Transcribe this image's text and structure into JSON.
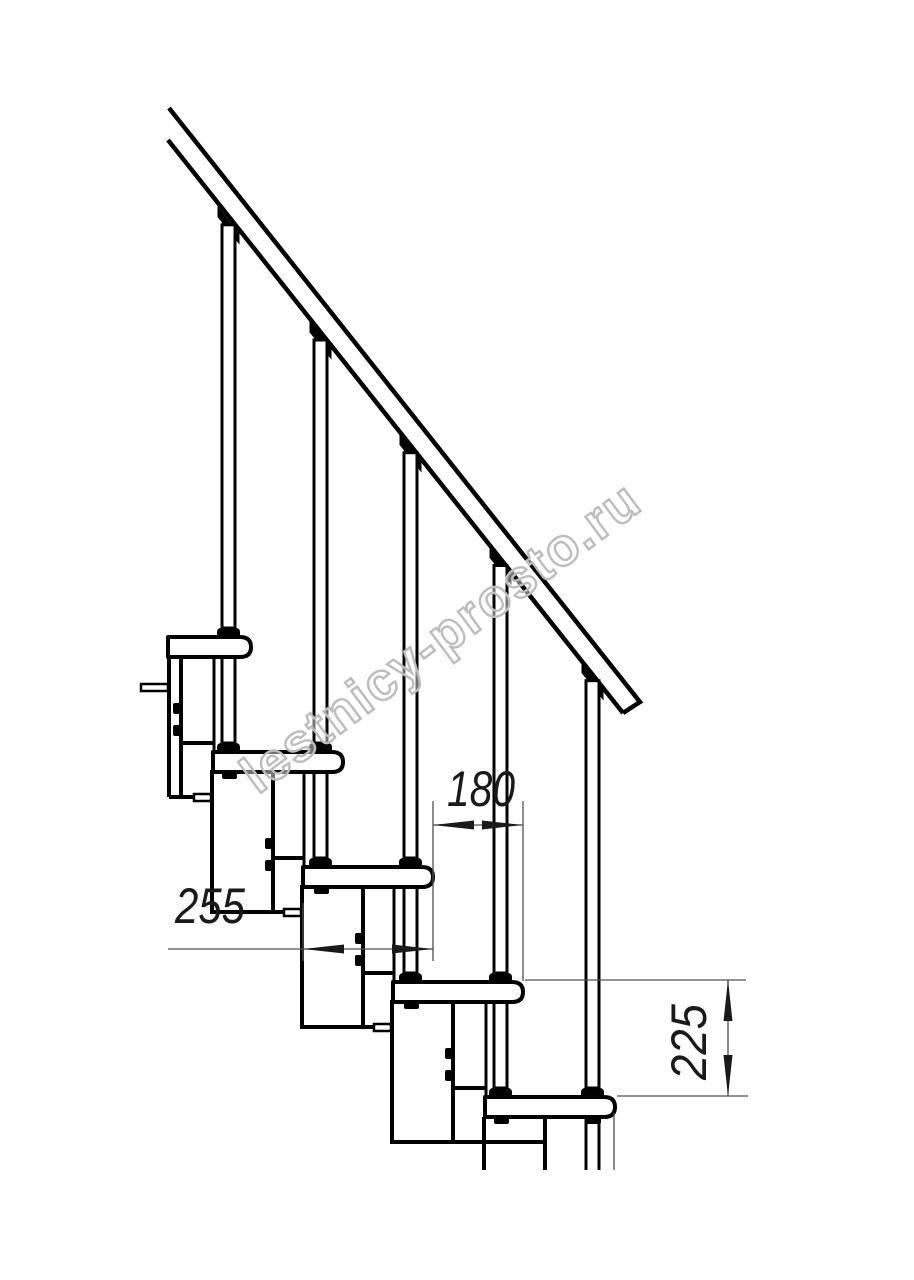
{
  "drawing": {
    "type": "staircase-side-view-technical-drawing",
    "watermark": "lestnicy-prosto.ru",
    "dimensions": {
      "step_run": {
        "value": "180"
      },
      "tread_length": {
        "value": "255"
      },
      "step_rise": {
        "value": "225"
      }
    },
    "counts": {
      "treads_visible": 5,
      "balusters_visible": 5
    },
    "colors": {
      "line": "#000000",
      "dim_line": "#4f4f4f",
      "dim_text": "#1a1a1a",
      "watermark": "#bdbdbd",
      "background": "#ffffff"
    }
  }
}
